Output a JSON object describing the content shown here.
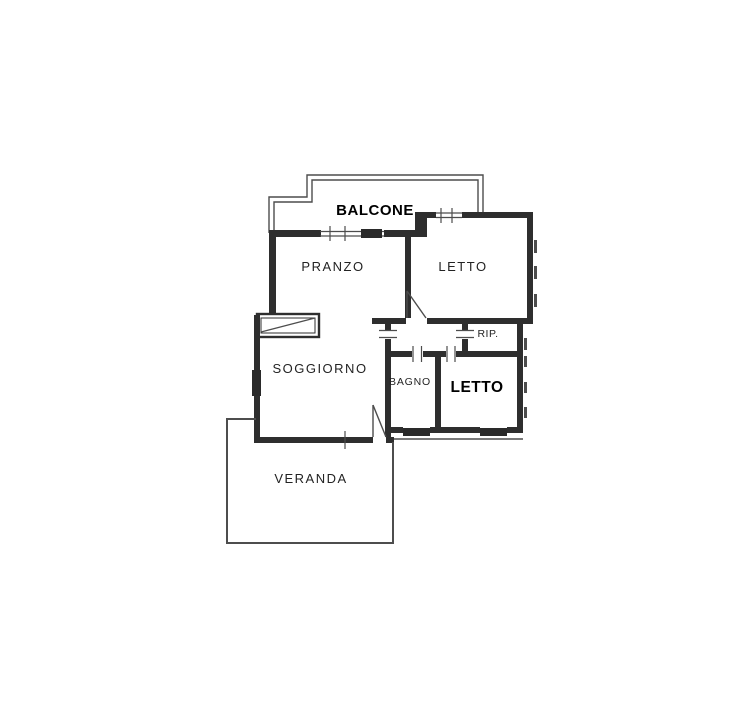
{
  "floorplan": {
    "canvas": {
      "width": 737,
      "height": 722,
      "background": "#ffffff",
      "wall_color": "#2e2e2e",
      "thin_color": "#4d4d4d",
      "block_color": "#2a2a2a",
      "label_color": "#232323",
      "bold_label_color": "#000000"
    },
    "rooms": [
      {
        "id": "balcone",
        "label": "BALCONE",
        "x": 375,
        "y": 215,
        "size": 15,
        "weight": 700,
        "ls": 0.5
      },
      {
        "id": "pranzo",
        "label": "PRANZO",
        "x": 333,
        "y": 271,
        "size": 13,
        "weight": 400,
        "ls": 1.5
      },
      {
        "id": "letto-nord",
        "label": "LETTO",
        "x": 463,
        "y": 271,
        "size": 13,
        "weight": 400,
        "ls": 1.5
      },
      {
        "id": "rip",
        "label": "RIP.",
        "x": 488,
        "y": 337,
        "size": 10.5,
        "weight": 400,
        "ls": 0.5
      },
      {
        "id": "soggiorno",
        "label": "SOGGIORNO",
        "x": 320,
        "y": 373,
        "size": 13,
        "weight": 400,
        "ls": 1.5
      },
      {
        "id": "bagno",
        "label": "BAGNO",
        "x": 410,
        "y": 385,
        "size": 10.5,
        "weight": 400,
        "ls": 0.8
      },
      {
        "id": "letto-sud",
        "label": "LETTO",
        "x": 477,
        "y": 392,
        "size": 15.5,
        "weight": 700,
        "ls": 0.5
      },
      {
        "id": "veranda",
        "label": "VERANDA",
        "x": 311,
        "y": 483,
        "size": 13,
        "weight": 400,
        "ls": 1.5
      }
    ],
    "walls": [
      [
        269,
        230,
        52,
        7
      ],
      [
        384,
        230,
        37,
        7
      ],
      [
        269,
        233,
        7,
        82
      ],
      [
        254,
        315,
        6,
        128
      ],
      [
        415,
        212,
        21,
        6
      ],
      [
        462,
        212,
        71,
        6
      ],
      [
        415,
        212,
        6,
        25
      ],
      [
        415,
        218,
        12,
        19
      ],
      [
        405,
        231,
        22,
        6
      ],
      [
        405,
        231,
        6,
        87
      ],
      [
        527,
        212,
        6,
        108
      ],
      [
        372,
        318,
        34,
        6
      ],
      [
        427,
        318,
        106,
        6
      ],
      [
        462,
        324,
        6,
        6
      ],
      [
        462,
        339,
        6,
        14
      ],
      [
        517,
        324,
        6,
        109
      ],
      [
        387,
        351,
        25,
        6
      ],
      [
        423,
        351,
        23,
        6
      ],
      [
        456,
        351,
        66,
        6
      ],
      [
        385,
        323,
        6,
        7
      ],
      [
        385,
        339,
        6,
        98
      ],
      [
        435,
        351,
        6,
        82
      ],
      [
        391,
        427,
        12,
        6
      ],
      [
        430,
        427,
        50,
        6
      ],
      [
        507,
        427,
        15,
        6
      ],
      [
        254,
        437,
        119,
        6
      ],
      [
        386,
        437,
        8,
        6
      ]
    ],
    "dark_blocks": [
      [
        361,
        229,
        21,
        9
      ],
      [
        252,
        370,
        9,
        26
      ],
      [
        403,
        428,
        27,
        8
      ],
      [
        480,
        428,
        27,
        8
      ]
    ],
    "dashes": [
      [
        534,
        240,
        3,
        13
      ],
      [
        534,
        266,
        3,
        13
      ],
      [
        534,
        294,
        3,
        13
      ],
      [
        524,
        338,
        3,
        12
      ],
      [
        524,
        356,
        3,
        11
      ],
      [
        524,
        382,
        3,
        11
      ],
      [
        524,
        407,
        3,
        11
      ]
    ],
    "polylines": [
      {
        "points": "269,233 269,197 307,197 307,175 483,175 483,213",
        "w": 1.4
      },
      {
        "points": "274,233 274,202 312,202 312,180 478,180 478,213",
        "w": 1.4
      }
    ],
    "hollow_rects": [
      {
        "x": 257,
        "y": 314,
        "w": 62,
        "h": 23,
        "sw": 2.4
      },
      {
        "x": 261,
        "y": 318,
        "w": 54,
        "h": 15,
        "sw": 1
      }
    ],
    "lines": [
      {
        "n": "stair-diagonal",
        "x1": 261,
        "y1": 332,
        "x2": 315,
        "y2": 318,
        "w": 1.2
      },
      {
        "n": "window-rail",
        "x1": 320,
        "y1": 231.5,
        "x2": 384,
        "y2": 231.5,
        "w": 1.2
      },
      {
        "n": "window-rail",
        "x1": 320,
        "y1": 236,
        "x2": 384,
        "y2": 236,
        "w": 1.2
      },
      {
        "n": "window-tick",
        "x1": 330,
        "y1": 226,
        "x2": 330,
        "y2": 241,
        "w": 1.2
      },
      {
        "n": "window-tick",
        "x1": 345,
        "y1": 226,
        "x2": 345,
        "y2": 241,
        "w": 1.2
      },
      {
        "n": "window-rail",
        "x1": 436,
        "y1": 213,
        "x2": 462,
        "y2": 213,
        "w": 1.2
      },
      {
        "n": "window-rail",
        "x1": 436,
        "y1": 217.5,
        "x2": 462,
        "y2": 217.5,
        "w": 1.2
      },
      {
        "n": "window-tick",
        "x1": 441,
        "y1": 208,
        "x2": 441,
        "y2": 223,
        "w": 1.2
      },
      {
        "n": "window-tick",
        "x1": 452,
        "y1": 208,
        "x2": 452,
        "y2": 223,
        "w": 1.2
      },
      {
        "n": "door-leaf",
        "x1": 407,
        "y1": 291,
        "x2": 407,
        "y2": 318,
        "w": 1.4
      },
      {
        "n": "door-swing",
        "x1": 407,
        "y1": 291,
        "x2": 426,
        "y2": 318,
        "w": 1.4
      },
      {
        "n": "doorway-tick",
        "x1": 379,
        "y1": 330.5,
        "x2": 397,
        "y2": 330.5,
        "w": 1.2
      },
      {
        "n": "doorway-tick",
        "x1": 379,
        "y1": 337.5,
        "x2": 397,
        "y2": 337.5,
        "w": 1.2
      },
      {
        "n": "doorway-tick",
        "x1": 456,
        "y1": 330.5,
        "x2": 474,
        "y2": 330.5,
        "w": 1.2
      },
      {
        "n": "doorway-tick",
        "x1": 456,
        "y1": 337.5,
        "x2": 474,
        "y2": 337.5,
        "w": 1.2
      },
      {
        "n": "doorway-tick",
        "x1": 413,
        "y1": 346,
        "x2": 413,
        "y2": 362,
        "w": 1.2
      },
      {
        "n": "doorway-tick",
        "x1": 421.5,
        "y1": 346,
        "x2": 421.5,
        "y2": 362,
        "w": 1.2
      },
      {
        "n": "doorway-tick",
        "x1": 447,
        "y1": 346,
        "x2": 447,
        "y2": 362,
        "w": 1.2
      },
      {
        "n": "doorway-tick",
        "x1": 455,
        "y1": 346,
        "x2": 455,
        "y2": 362,
        "w": 1.2
      },
      {
        "n": "window-tick",
        "x1": 345,
        "y1": 431,
        "x2": 345,
        "y2": 449,
        "w": 1.2
      },
      {
        "n": "door-leaf",
        "x1": 373,
        "y1": 405,
        "x2": 373,
        "y2": 437,
        "w": 1.4
      },
      {
        "n": "door-swing",
        "x1": 373,
        "y1": 405,
        "x2": 386,
        "y2": 437,
        "w": 1.4
      },
      {
        "n": "outer-line",
        "x1": 394,
        "y1": 439,
        "x2": 523,
        "y2": 439,
        "w": 1.4
      },
      {
        "n": "veranda-wall-left",
        "x1": 227,
        "y1": 418,
        "x2": 227,
        "y2": 544,
        "w": 2
      },
      {
        "n": "veranda-wall-top",
        "x1": 226,
        "y1": 419,
        "x2": 256,
        "y2": 419,
        "w": 2
      },
      {
        "n": "veranda-wall-bottom",
        "x1": 226,
        "y1": 543,
        "x2": 394,
        "y2": 543,
        "w": 2
      },
      {
        "n": "veranda-wall-right",
        "x1": 393,
        "y1": 442,
        "x2": 393,
        "y2": 544,
        "w": 2
      }
    ]
  }
}
